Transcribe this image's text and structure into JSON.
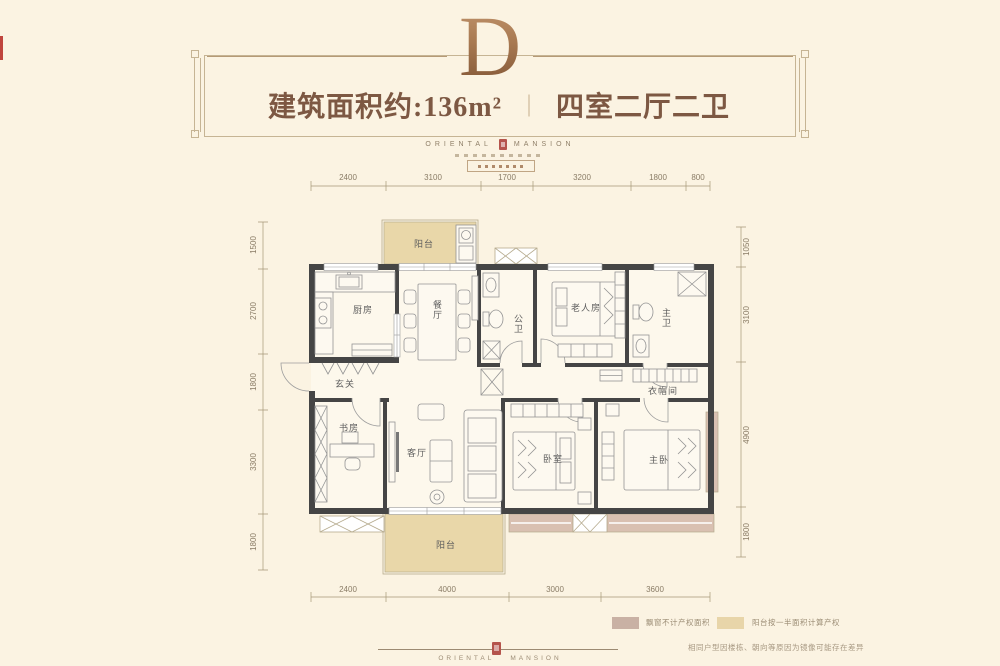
{
  "header": {
    "unit_letter": "D",
    "area_label": "建筑面积约:136m²",
    "divider": "｜",
    "layout_label": "四室二厅二卫"
  },
  "brand": {
    "left": "ORIENTAL",
    "right": "MANSION"
  },
  "plan": {
    "rooms": {
      "balcony_north": "阳台",
      "kitchen": "厨房",
      "dining": "餐厅",
      "guest_bath": "公卫",
      "elder_room": "老人房",
      "master_bath": "主卫",
      "foyer": "玄关",
      "cloakroom": "衣帽间",
      "study": "书房",
      "living": "客厅",
      "bedroom": "卧室",
      "master_bedroom": "主卧",
      "balcony_south": "阳台"
    }
  },
  "dimensions": {
    "top": [
      "2400",
      "3100",
      "1700",
      "3200",
      "1800",
      "800"
    ],
    "bottom": [
      "2400",
      "4000",
      "3000",
      "3600"
    ],
    "left": [
      "1500",
      "2700",
      "1800",
      "3300",
      "1800"
    ],
    "right": [
      "1050",
      "3100",
      "4900",
      "1800"
    ]
  },
  "legend": {
    "items": [
      {
        "color": "#c9b1a4",
        "label": "飘窗不计产权面积"
      },
      {
        "color": "#e8d5a9",
        "label": "阳台按一半面积计算产权"
      }
    ]
  },
  "footer": {
    "disclaimer": "相同户型因楼栋、朝向等原因为镜像可能存在差异"
  },
  "colors": {
    "wall": "#454545",
    "balcony_fill": "#e9d7a9",
    "bay_fill": "#d9c0b1",
    "accent_red": "#b5544c",
    "bronze": "#a0714a"
  }
}
